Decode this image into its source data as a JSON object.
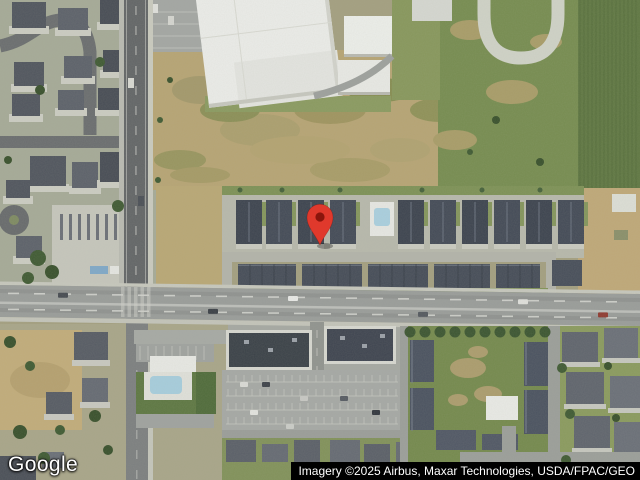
{
  "map": {
    "view_type": "satellite-imagery",
    "marker": {
      "fill": "#E0392C",
      "dot_fill": "#8A150C",
      "tip_x": 320,
      "tip_y": 245
    },
    "features": [
      "residential-neighborhood-northwest",
      "school-campus-white-buildings",
      "running-track-oval",
      "vacant-dirt-lot",
      "farm-field-east",
      "townhome-rows-center",
      "main-road-intersection",
      "swimming-pool-clubhouse",
      "commercial-buildings-parking-lot",
      "apartment-complex-courtyard",
      "red-location-pin"
    ]
  },
  "watermark": {
    "logo_text": "Google"
  },
  "attribution": {
    "text": "Imagery ©2025 Airbus, Maxar Technologies, USDA/FPAC/GEO"
  },
  "palette": {
    "grass": "#7d9154",
    "dirt": "#b6a474",
    "farm_field": "#5f7742",
    "asphalt_dark": "#626567",
    "asphalt_main": "#999c9a",
    "concrete": "#c9cabf",
    "roof_dark": "#3c434f",
    "building_white": "#ebece9",
    "pool_water": "#a9cfdf",
    "tree_green": "#3f5a33",
    "attribution_bg": "#000000",
    "attribution_fg": "#ffffff"
  }
}
